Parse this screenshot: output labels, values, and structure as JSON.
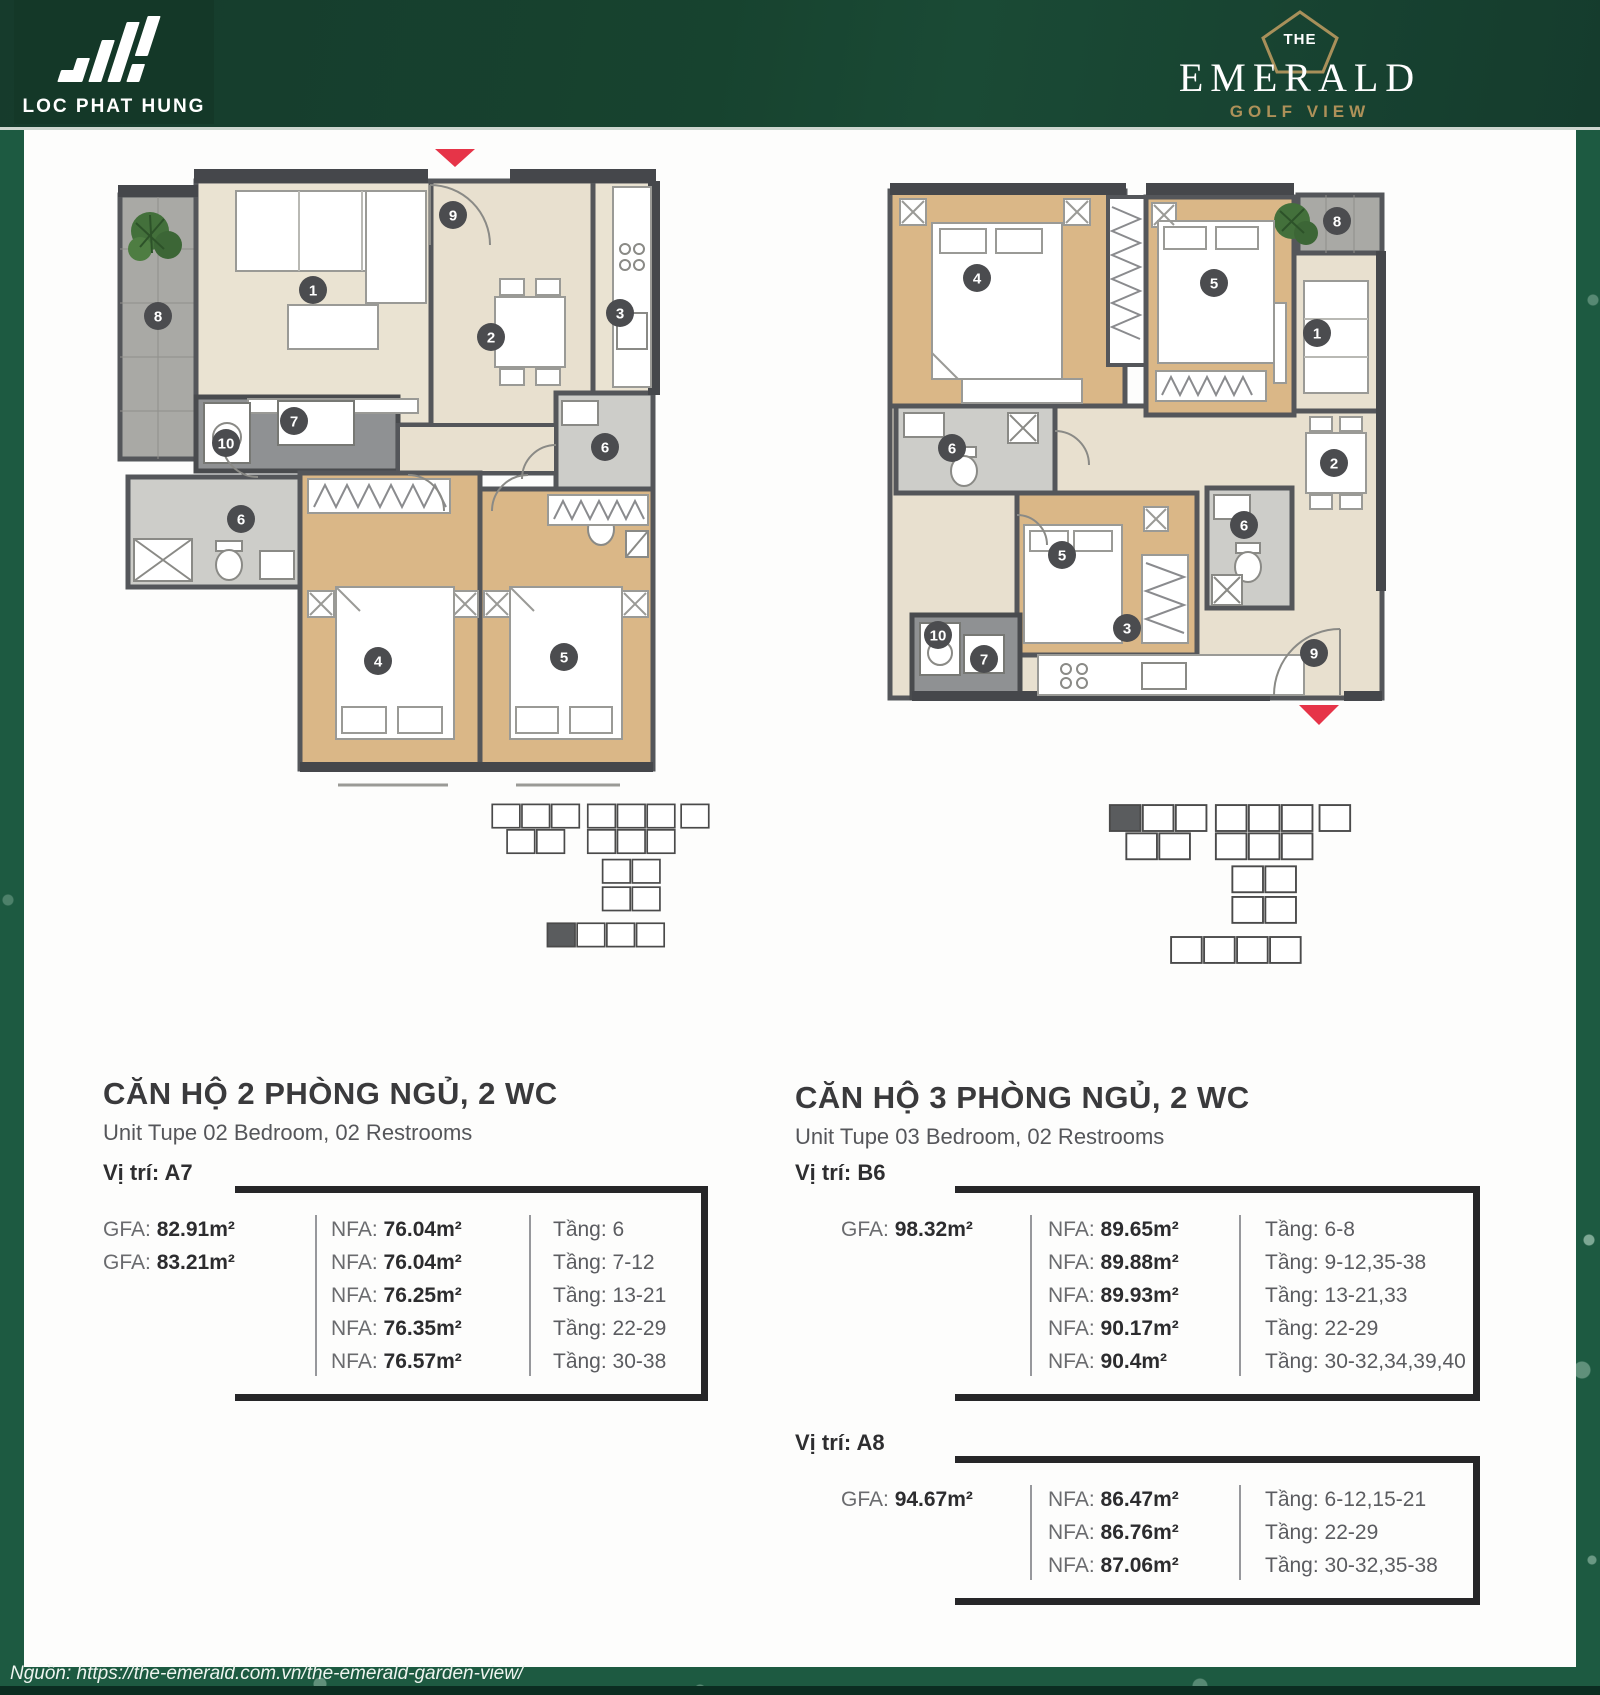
{
  "brand": {
    "left_name": "LOC PHAT HUNG",
    "right_the": "THE",
    "right_name": "EMERALD",
    "right_tagline": "GOLF VIEW"
  },
  "colors": {
    "green_dark": "#17432f",
    "green_border": "#1d5a41",
    "gold": "#ae9159",
    "red_marker": "#e63448",
    "wall": "#54565a",
    "floor_beige": "#e9e2d1",
    "floor_wood": "#dab787",
    "balcony_gray": "#a9a9a5",
    "bath_gray": "#cdcdc9",
    "utility_gray": "#8f9193",
    "badge": "#4b4c4f"
  },
  "labels": {
    "gfa": "GFA:",
    "nfa": "NFA:",
    "tang": "Tầng:"
  },
  "units": [
    {
      "title": "CĂN HỘ 2 PHÒNG NGỦ, 2 WC",
      "subtitle": "Unit Tupe 02 Bedroom, 02 Restrooms",
      "locations": [
        {
          "label": "Vị trí: A7",
          "gfa": [
            "82.91m²",
            "83.21m²"
          ],
          "rows": [
            {
              "nfa": "76.04m²",
              "tang": "6"
            },
            {
              "nfa": "76.04m²",
              "tang": "7-12"
            },
            {
              "nfa": "76.25m²",
              "tang": "13-21"
            },
            {
              "nfa": "76.35m²",
              "tang": "22-29"
            },
            {
              "nfa": "76.57m²",
              "tang": "30-38"
            }
          ]
        }
      ]
    },
    {
      "title": "CĂN HỘ 3 PHÒNG NGỦ, 2 WC",
      "subtitle": "Unit Tupe 03 Bedroom, 02 Restrooms",
      "locations": [
        {
          "label": "Vị trí: B6",
          "gfa": [
            "98.32m²"
          ],
          "rows": [
            {
              "nfa": "89.65m²",
              "tang": "6-8"
            },
            {
              "nfa": "89.88m²",
              "tang": "9-12,35-38"
            },
            {
              "nfa": "89.93m²",
              "tang": "13-21,33"
            },
            {
              "nfa": "90.17m²",
              "tang": "22-29"
            },
            {
              "nfa": "90.4m²",
              "tang": "30-32,34,39,40"
            }
          ]
        },
        {
          "label": "Vị trí: A8",
          "gfa": [
            "94.67m²"
          ],
          "rows": [
            {
              "nfa": "86.47m²",
              "tang": "6-12,15-21"
            },
            {
              "nfa": "86.76m²",
              "tang": "22-29"
            },
            {
              "nfa": "87.06m²",
              "tang": "30-32,35-38"
            }
          ]
        }
      ]
    }
  ],
  "plan_left": {
    "rooms": [
      {
        "n": "1",
        "x": 205,
        "y": 145
      },
      {
        "n": "2",
        "x": 383,
        "y": 192
      },
      {
        "n": "3",
        "x": 512,
        "y": 168
      },
      {
        "n": "9",
        "x": 345,
        "y": 70
      },
      {
        "n": "8",
        "x": 50,
        "y": 171
      },
      {
        "n": "7",
        "x": 186,
        "y": 276
      },
      {
        "n": "10",
        "x": 118,
        "y": 298
      },
      {
        "n": "6",
        "x": 133,
        "y": 374
      },
      {
        "n": "6",
        "x": 497,
        "y": 302
      },
      {
        "n": "4",
        "x": 270,
        "y": 516
      },
      {
        "n": "5",
        "x": 456,
        "y": 512
      }
    ]
  },
  "plan_right": {
    "rooms": [
      {
        "n": "4",
        "x": 165,
        "y": 115
      },
      {
        "n": "5",
        "x": 402,
        "y": 120
      },
      {
        "n": "1",
        "x": 505,
        "y": 170
      },
      {
        "n": "8",
        "x": 525,
        "y": 58
      },
      {
        "n": "6",
        "x": 140,
        "y": 285
      },
      {
        "n": "5",
        "x": 250,
        "y": 392
      },
      {
        "n": "6",
        "x": 432,
        "y": 362
      },
      {
        "n": "2",
        "x": 522,
        "y": 300
      },
      {
        "n": "3",
        "x": 315,
        "y": 465
      },
      {
        "n": "10",
        "x": 126,
        "y": 472
      },
      {
        "n": "7",
        "x": 172,
        "y": 496
      },
      {
        "n": "9",
        "x": 502,
        "y": 490
      }
    ]
  },
  "keyplan": {
    "unit_w": 26,
    "unit_h": 22,
    "units": [
      [
        4,
        6
      ],
      [
        32,
        6
      ],
      [
        60,
        6
      ],
      [
        94,
        6
      ],
      [
        122,
        6
      ],
      [
        150,
        6
      ],
      [
        182,
        6
      ],
      [
        18,
        30
      ],
      [
        46,
        30
      ],
      [
        94,
        30
      ],
      [
        122,
        30
      ],
      [
        150,
        30
      ],
      [
        108,
        58
      ],
      [
        136,
        58
      ],
      [
        108,
        84
      ],
      [
        136,
        84
      ],
      [
        56,
        118
      ],
      [
        84,
        118
      ],
      [
        112,
        118
      ],
      [
        140,
        118
      ]
    ],
    "highlight_left": 16,
    "highlight_right": 0
  },
  "footer": {
    "source": "Nguồn: https://the-emerald.com.vn/the-emerald-garden-view/"
  }
}
